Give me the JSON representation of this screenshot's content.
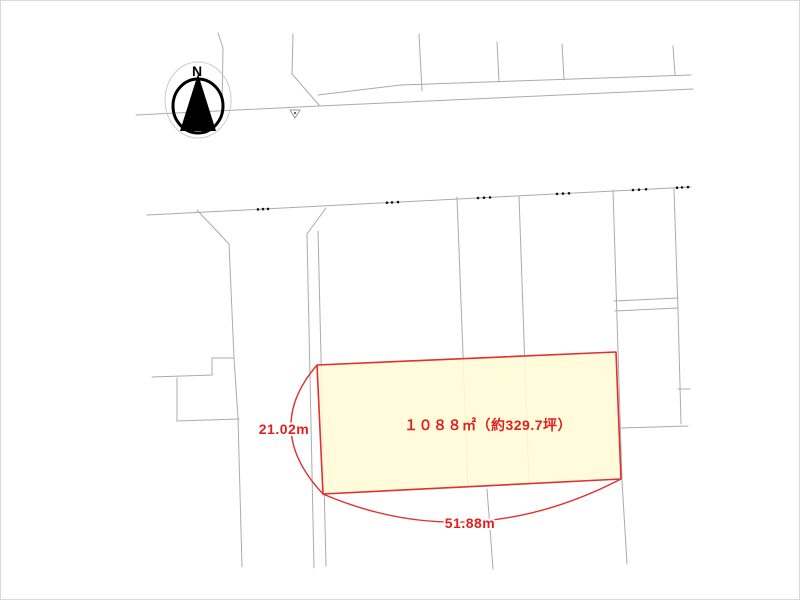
{
  "colors": {
    "background": "#ffffff",
    "line_gray": "#ababab",
    "marker_black": "#161616",
    "dimension_red": "#e03030",
    "text_red": "#e01f1f",
    "parcel_fill": "#fffbd6",
    "parcel_border": "#e03030"
  },
  "compass": {
    "north_label": "N"
  },
  "parcel": {
    "area_label": "１０８８㎡（約329.7坪）",
    "area_m2": "1088",
    "area_tsubo": "329.7",
    "frontage_label": "51.88m",
    "depth_label": "21.02m"
  }
}
